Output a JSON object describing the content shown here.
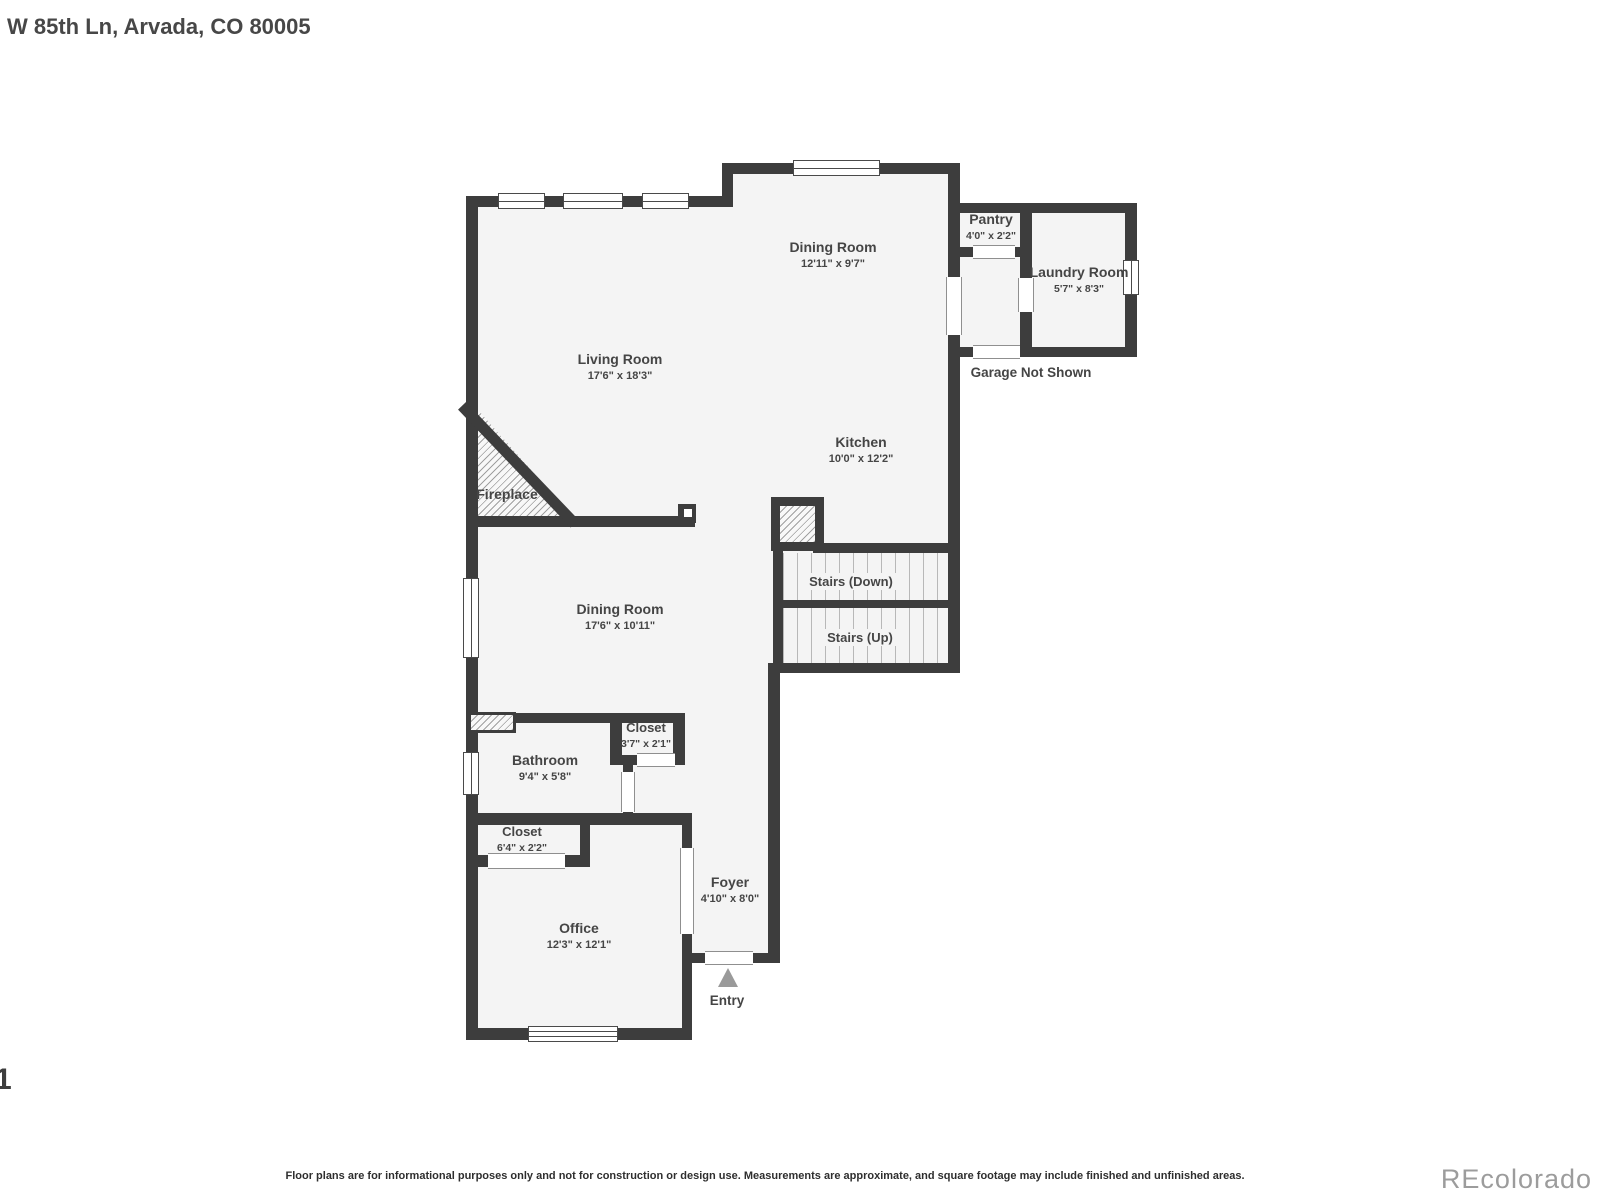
{
  "title": "W 85th Ln, Arvada, CO 80005",
  "page_number": "1",
  "watermark": "REcolorado",
  "disclaimer": "Floor plans are for informational purposes only and not for construction or design use. Measurements are approximate, and square footage may include finished and unfinished areas.",
  "colors": {
    "wall": "#3d3d3d",
    "floor": "#f4f4f4",
    "text": "#454545",
    "watermark": "#9c9c9c",
    "entry_arrow": "#9a9a9a"
  },
  "rooms": {
    "dining_upper": {
      "name": "Dining Room",
      "dims": "12'11\" x 9'7\""
    },
    "living": {
      "name": "Living Room",
      "dims": "17'6\" x 18'3\""
    },
    "kitchen": {
      "name": "Kitchen",
      "dims": "10'0\" x 12'2\""
    },
    "pantry": {
      "name": "Pantry",
      "dims": "4'0\" x 2'2\""
    },
    "laundry": {
      "name": "Laundry Room",
      "dims": "5'7\" x 8'3\""
    },
    "dining_lower": {
      "name": "Dining Room",
      "dims": "17'6\" x 10'11\""
    },
    "closet_hall": {
      "name": "Closet",
      "dims": "3'7\" x 2'1\""
    },
    "bathroom": {
      "name": "Bathroom",
      "dims": "9'4\" x 5'8\""
    },
    "closet_office": {
      "name": "Closet",
      "dims": "6'4\" x 2'2\""
    },
    "office": {
      "name": "Office",
      "dims": "12'3\" x 12'1\""
    },
    "foyer": {
      "name": "Foyer",
      "dims": "4'10\" x 8'0\""
    }
  },
  "annotations": {
    "garage": "Garage Not Shown",
    "fireplace": "Fireplace",
    "stairs_down": "Stairs (Down)",
    "stairs_up": "Stairs (Up)",
    "entry": "Entry"
  }
}
